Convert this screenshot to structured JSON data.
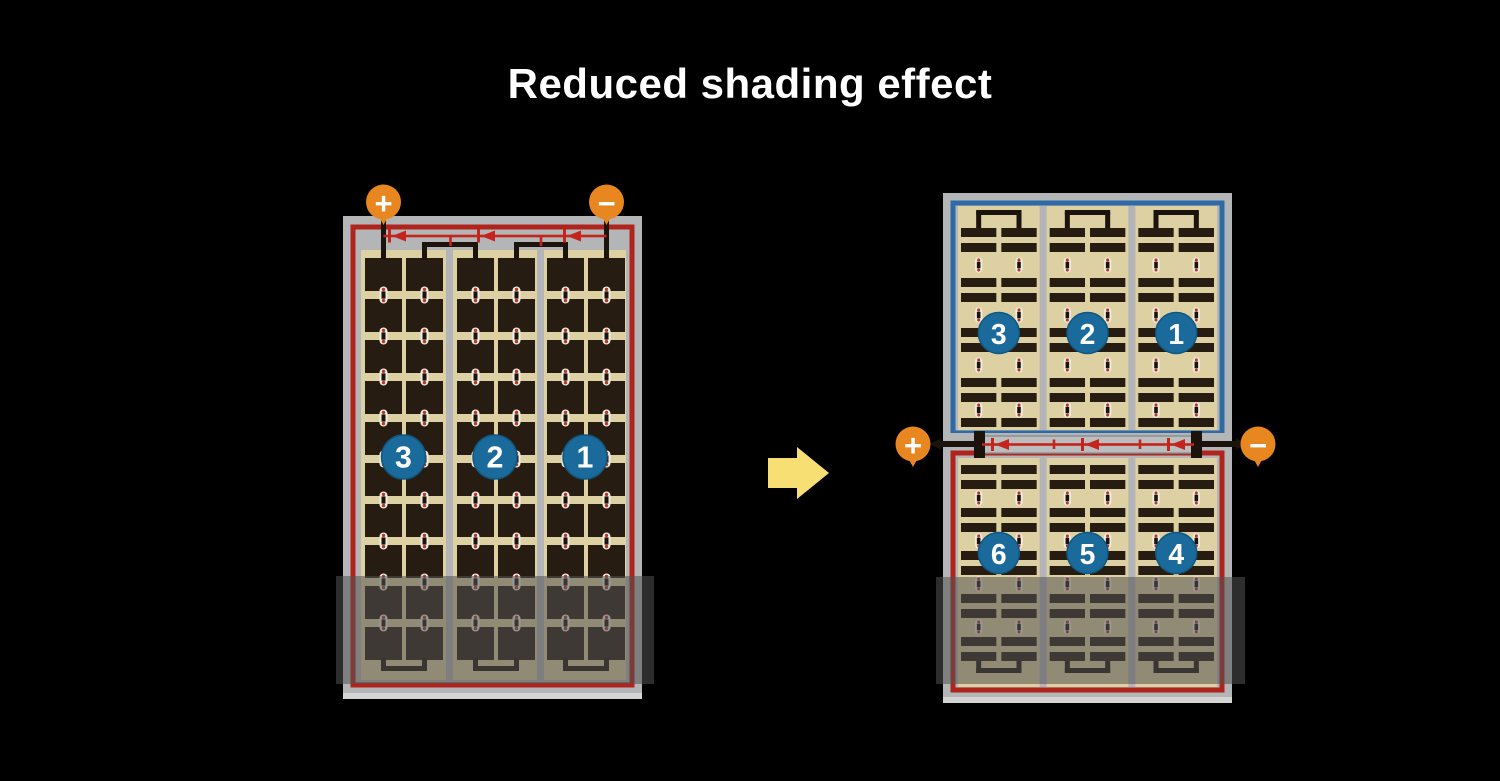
{
  "title": "Reduced shading effect",
  "colors": {
    "background": "#000000",
    "title_text": "#ffffff",
    "frame": "#b4b5b7",
    "frame_bevel": "#d4d4d4",
    "border_red": "#b0241e",
    "border_blue": "#2e6ba4",
    "panel": "#ddd0a3",
    "cell": "#261c12",
    "divider": "#b3b4b8",
    "wire": "#1c130c",
    "diode_red": "#c5241c",
    "terminal_orange": "#e8861f",
    "terminal_symbol": "#ffffff",
    "badge_blue": "#1a6b9c",
    "badge_text": "#ffffff",
    "contact_white": "#f2ede1",
    "contact_red": "#b5362a",
    "junction_strip": "#bcbdbf",
    "junction_strip_edge": "#8f9092",
    "arrow_yellow": "#f8df74",
    "shade": "rgba(82,82,82,0.55)"
  },
  "left_module": {
    "description": "full-size module with bottom shading",
    "terminals": {
      "positive": "+",
      "negative": "−"
    },
    "cell_strings": [
      "3",
      "2",
      "1"
    ],
    "shaded": true
  },
  "right_modules": {
    "terminals": {
      "positive": "+",
      "negative": "−"
    },
    "top": {
      "border": "blue",
      "cell_strings": [
        "3",
        "2",
        "1"
      ],
      "shaded": false
    },
    "bottom": {
      "border": "red",
      "cell_strings": [
        "6",
        "5",
        "4"
      ],
      "shaded": true
    }
  },
  "transform_arrow": {
    "direction": "right"
  }
}
